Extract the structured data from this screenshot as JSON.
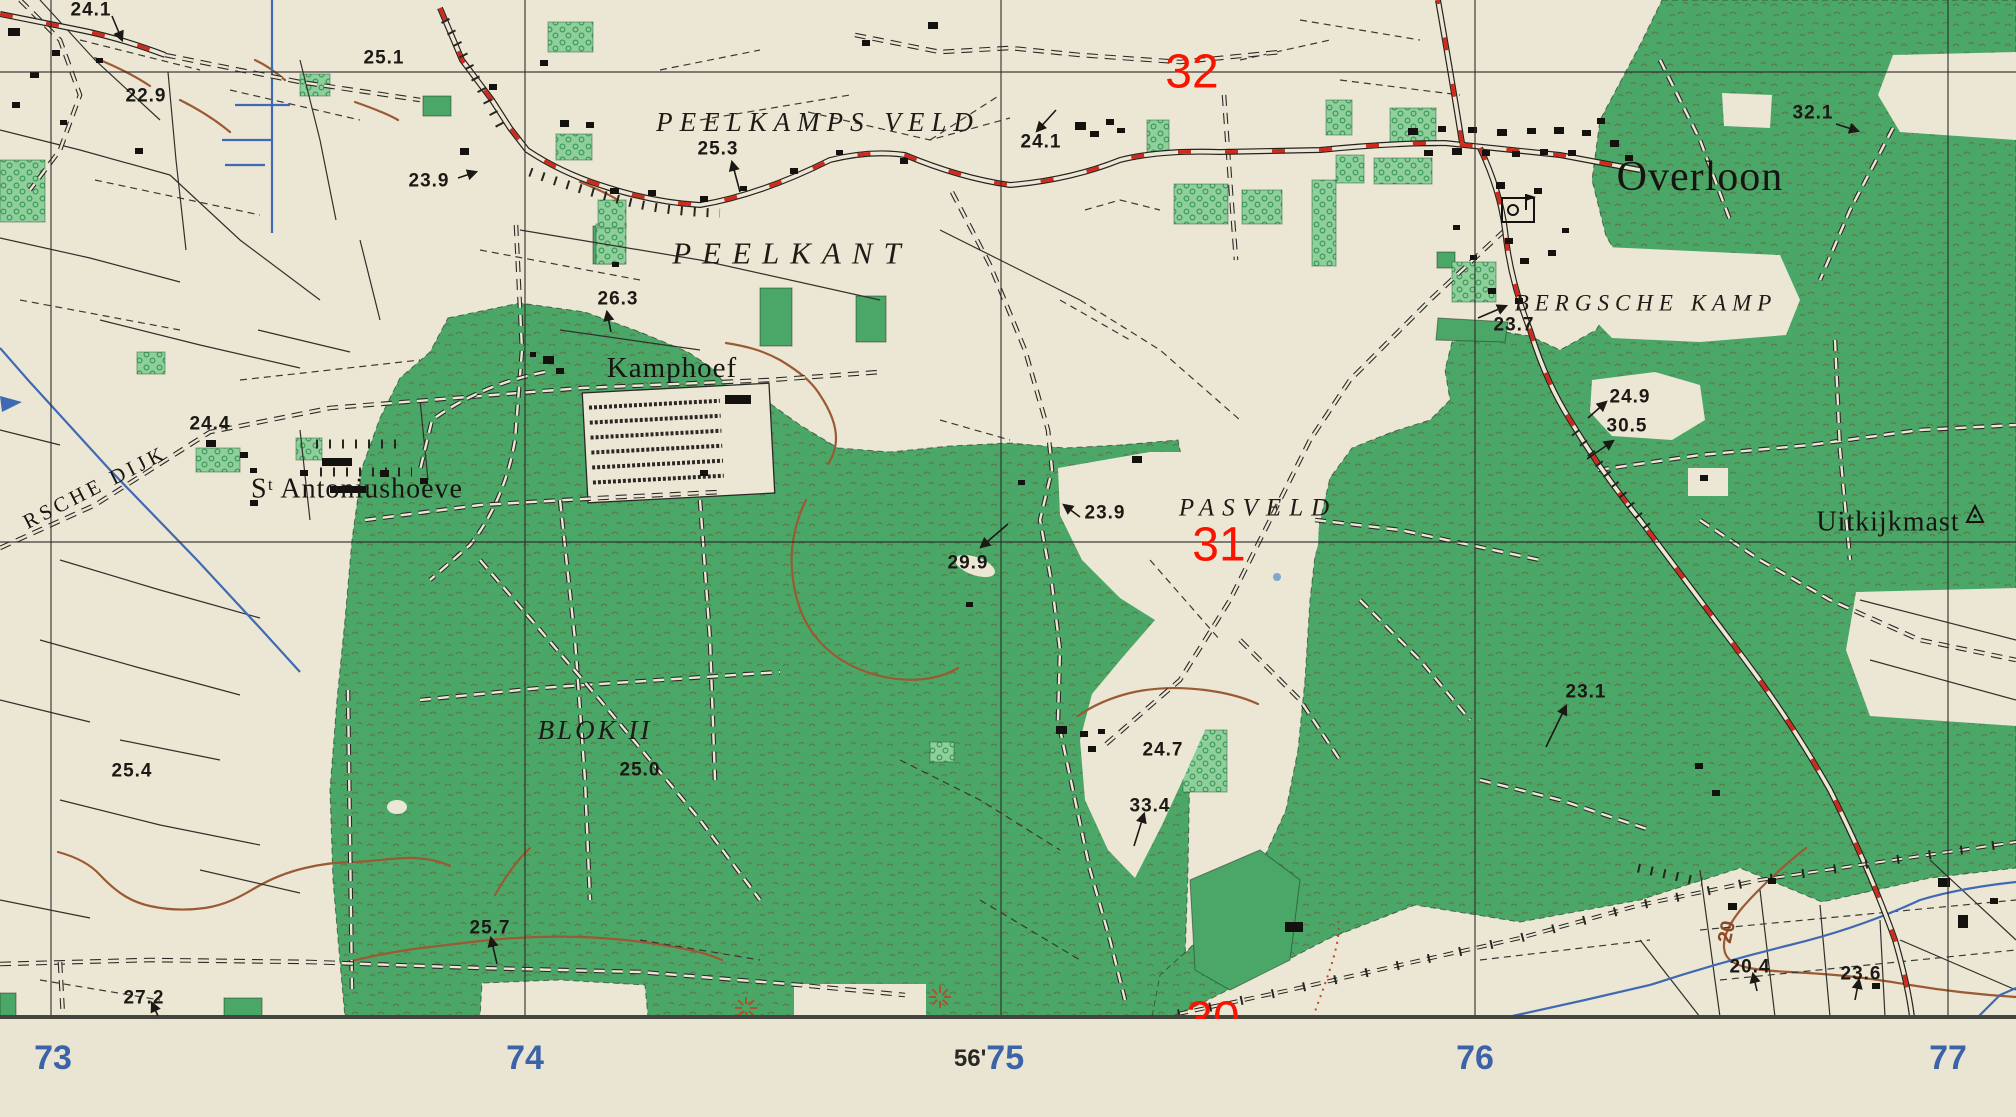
{
  "map": {
    "type": "topographic-map-sheet",
    "colors": {
      "paper": "#ece7d5",
      "forest_green": "#4ba768",
      "orchard_green": "#8ecf9c",
      "road_red": "#cf2a1b",
      "overlay_red": "#f81400",
      "water_blue": "#3f6ab3",
      "grid_blue": "#3c63a8",
      "contour_brown": "#9b5a33",
      "ink_black": "#1b1914"
    },
    "places": [
      {
        "text": "PEELKAMPS  VELD",
        "x": 818,
        "y": 122,
        "style": "italic",
        "size": 27,
        "spacing": 7,
        "rotate": 0
      },
      {
        "text": "PEELKANT",
        "x": 792,
        "y": 253,
        "style": "italic",
        "size": 31,
        "spacing": 11,
        "rotate": 0
      },
      {
        "text": "Kamphoef",
        "x": 672,
        "y": 368,
        "style": "roman",
        "size": 29,
        "spacing": 1,
        "rotate": 0
      },
      {
        "text": "Overloon",
        "x": 1700,
        "y": 177,
        "style": "roman",
        "size": 42,
        "spacing": 1,
        "rotate": 0
      },
      {
        "text": "BERGSCHE   KAMP",
        "x": 1646,
        "y": 303,
        "style": "italic",
        "size": 23,
        "spacing": 6,
        "rotate": 0
      },
      {
        "text": "PASVELD",
        "x": 1258,
        "y": 508,
        "style": "italic",
        "size": 25,
        "spacing": 8,
        "rotate": 0
      },
      {
        "text": "BLOK II",
        "x": 595,
        "y": 730,
        "style": "italic",
        "size": 27,
        "spacing": 3,
        "rotate": 0
      },
      {
        "text": "Uitkijkmast",
        "x": 1888,
        "y": 522,
        "style": "roman",
        "size": 28,
        "spacing": 1,
        "rotate": 0
      },
      {
        "text": "Sᵗ Antoniushoeve",
        "x": 357,
        "y": 489,
        "style": "roman",
        "size": 28,
        "spacing": 1,
        "rotate": 0
      },
      {
        "text": "RSCHE  DIJK",
        "x": 95,
        "y": 487,
        "style": "roman",
        "size": 21,
        "spacing": 4,
        "rotate": -27
      }
    ],
    "spot_heights": [
      {
        "v": "24.1",
        "x": 91,
        "y": 10,
        "arrow": [
          112,
          16,
          122,
          40
        ]
      },
      {
        "v": "22.9",
        "x": 146,
        "y": 96
      },
      {
        "v": "25.1",
        "x": 384,
        "y": 58
      },
      {
        "v": "23.9",
        "x": 429,
        "y": 181,
        "arrow": [
          458,
          178,
          476,
          172
        ]
      },
      {
        "v": "25.3",
        "x": 718,
        "y": 149,
        "arrow": [
          740,
          192,
          732,
          162
        ]
      },
      {
        "v": "24.1",
        "x": 1041,
        "y": 142,
        "arrow": [
          1056,
          110,
          1037,
          131
        ]
      },
      {
        "v": "26.3",
        "x": 618,
        "y": 299,
        "arrow": [
          611,
          332,
          607,
          312
        ]
      },
      {
        "v": "24.4",
        "x": 210,
        "y": 424
      },
      {
        "v": "23.7",
        "x": 1514,
        "y": 325,
        "arrow": [
          1478,
          318,
          1506,
          306
        ]
      },
      {
        "v": "24.9",
        "x": 1630,
        "y": 397,
        "arrow": [
          1588,
          418,
          1606,
          402
        ]
      },
      {
        "v": "30.5",
        "x": 1627,
        "y": 426,
        "arrow": [
          1587,
          459,
          1613,
          441
        ]
      },
      {
        "v": "32.1",
        "x": 1813,
        "y": 113,
        "arrow": [
          1836,
          124,
          1858,
          131
        ]
      },
      {
        "v": "23.9",
        "x": 1105,
        "y": 513,
        "arrow": [
          1080,
          517,
          1064,
          505
        ]
      },
      {
        "v": "29.9",
        "x": 968,
        "y": 563,
        "arrow": [
          1008,
          524,
          981,
          547
        ]
      },
      {
        "v": "25.4",
        "x": 132,
        "y": 771
      },
      {
        "v": "25.0",
        "x": 640,
        "y": 770
      },
      {
        "v": "25.7",
        "x": 490,
        "y": 928,
        "arrow": [
          497,
          964,
          491,
          938
        ]
      },
      {
        "v": "27.2",
        "x": 144,
        "y": 998,
        "arrow": [
          158,
          1016,
          152,
          1003
        ]
      },
      {
        "v": "23.1",
        "x": 1586,
        "y": 692,
        "arrow": [
          1546,
          747,
          1566,
          706
        ]
      },
      {
        "v": "24.7",
        "x": 1163,
        "y": 750
      },
      {
        "v": "33.4",
        "x": 1150,
        "y": 806,
        "arrow": [
          1134,
          846,
          1144,
          814
        ]
      },
      {
        "v": "20.4",
        "x": 1750,
        "y": 967,
        "arrow": [
          1757,
          991,
          1753,
          974
        ]
      },
      {
        "v": "23.6",
        "x": 1861,
        "y": 974,
        "arrow": [
          1855,
          1000,
          1859,
          980
        ]
      }
    ],
    "contour_label": {
      "v": "20",
      "x": 1727,
      "y": 932,
      "rotate": -78
    },
    "grid": {
      "red_labels": [
        {
          "v": "32",
          "x": 1192,
          "y": 72
        },
        {
          "v": "31",
          "x": 1219,
          "y": 545
        },
        {
          "v": "30",
          "x": 1213,
          "y": 1019
        }
      ],
      "bottom_labels": [
        {
          "prefix": "",
          "v": "73",
          "x": 53
        },
        {
          "prefix": "",
          "v": "74",
          "x": 525
        },
        {
          "prefix": "56'",
          "v": "75",
          "x": 989
        },
        {
          "prefix": "",
          "v": "76",
          "x": 1475
        },
        {
          "prefix": "",
          "v": "77",
          "x": 1948
        }
      ],
      "v_lines": [
        51,
        525,
        1001,
        1475,
        1948
      ],
      "h_lines": [
        72,
        542
      ],
      "neatline_y": 1017
    }
  }
}
